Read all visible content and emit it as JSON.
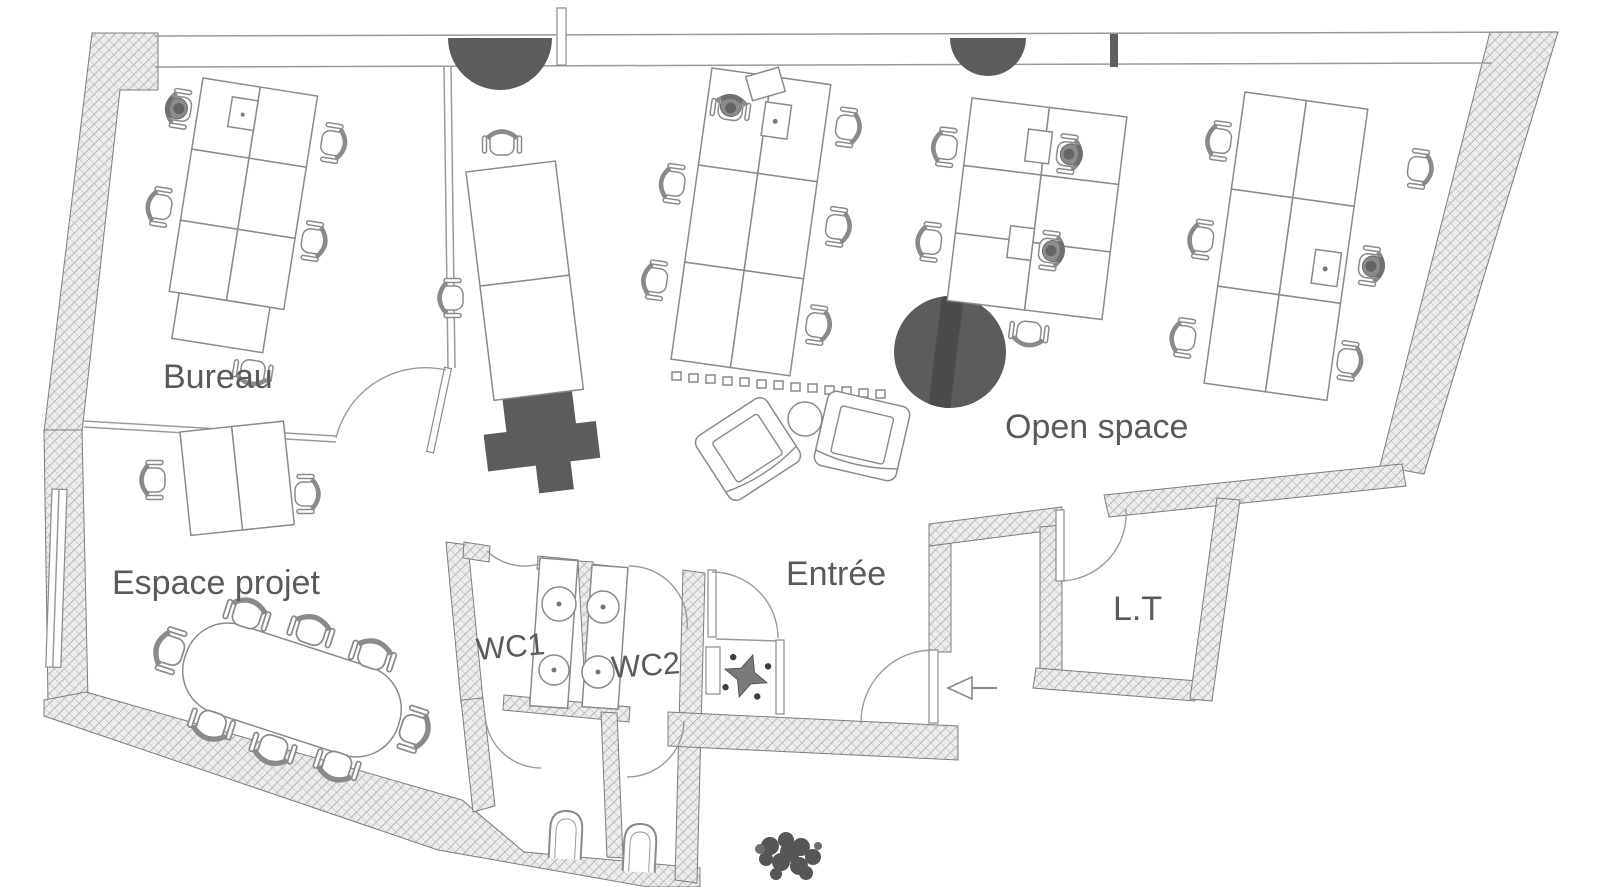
{
  "plan": {
    "title": "Office floor plan",
    "rooms": {
      "bureau": {
        "label": "Bureau"
      },
      "open_space": {
        "label": "Open space"
      },
      "espace_projet": {
        "label": "Espace projet"
      },
      "entree": {
        "label": "Entrée"
      },
      "wc1": {
        "label": "WC1"
      },
      "wc2": {
        "label": "WC2"
      },
      "lt": {
        "label": "L.T"
      }
    },
    "colors": {
      "wall_fill": "#ececec",
      "wall_hatch_line": "#a0a0a0",
      "wall_outline": "#7d7d7d",
      "furniture_line": "#8a8a8a",
      "dark_element": "#5c5c5c",
      "label_text": "#5a5a5a",
      "background": "#ffffff"
    },
    "elements": {
      "structural_columns": 2,
      "desk_clusters": 4,
      "occupied_desk_chairs": 6,
      "lounge_armchairs": 2,
      "lounge_round_table": 1,
      "meeting_table_chairs": 8,
      "wc_sinks": 4,
      "toilets": 2,
      "plants": 3,
      "entry_direction_arrow": "left"
    }
  }
}
